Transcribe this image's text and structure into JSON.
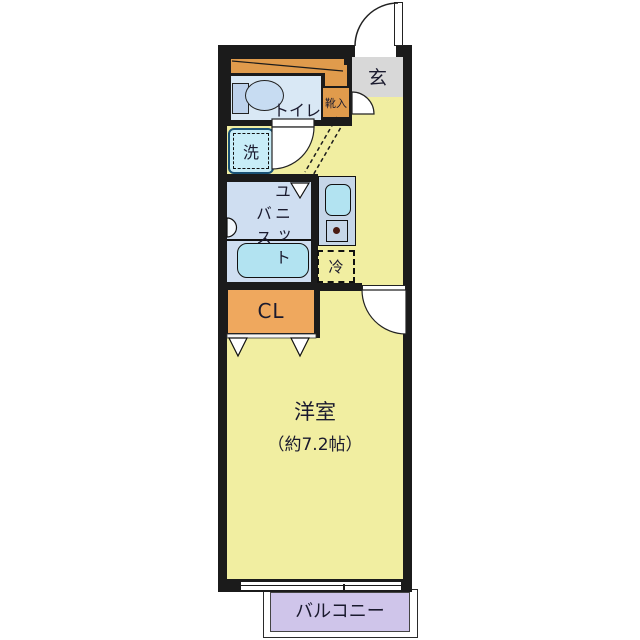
{
  "colors": {
    "wall": "#1b1b1b",
    "room-yellow": "#f1eea1",
    "genkan-gray": "#d8d8d8",
    "orange": "#e09b4c",
    "closet-orange": "#efa85e",
    "toilet-blue": "#d9e8f5",
    "bath-blue": "#cfdef1",
    "fixture-cyan": "#b2e3f1",
    "counter-blue": "#c6d6e8",
    "washer-cyan": "#c8edf8",
    "balcony-purple": "#cfc5ea",
    "ink": "#1a1a2e"
  },
  "rooms": {
    "entrance": {
      "label": "玄"
    },
    "shoe_cabinet": {
      "label": "靴入"
    },
    "toilet": {
      "label": "トイレ"
    },
    "washing_machine": {
      "label": "洗"
    },
    "unit_bath": {
      "label": "ユニットバス",
      "label_column_right": "ユニット",
      "label_column_left": "バス"
    },
    "refrigerator": {
      "label": "冷"
    },
    "closet": {
      "label": "CL"
    },
    "western_room": {
      "label": "洋室",
      "size": "（約7.2帖）"
    },
    "balcony": {
      "label": "バルコニー"
    }
  }
}
